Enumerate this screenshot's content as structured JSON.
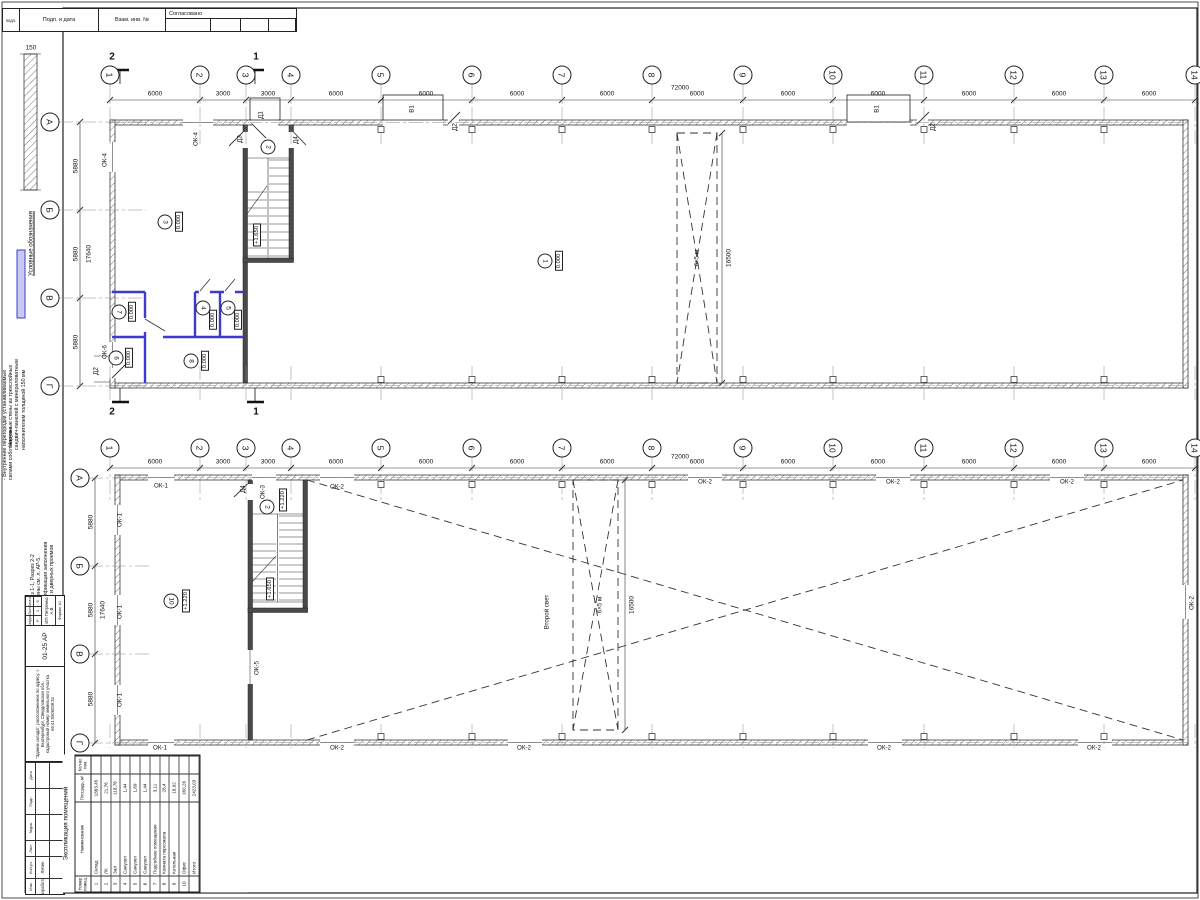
{
  "sheet": {
    "stamp_top": {
      "c1": "подл.",
      "c2": "Подп. и дата",
      "c3": "Взам. инв. №",
      "agreed": "Согласовано"
    },
    "legend": {
      "title": "Условные обозначения",
      "thickness": "150",
      "item1_lines": [
        {
          "t": "- Наружные стены из трехслойных"
        },
        {
          "t": "сандвич-панелей с минераловатным"
        },
        {
          "t": "наполнителем толщиной 150 мм"
        }
      ],
      "item2_lines": [
        {
          "t": "- Внутренние перегородки устанавливаемые"
        },
        {
          "t": "силами собственника"
        }
      ]
    },
    "notes": [
      {
        "t": "1. Разрез 1-1, Разрез 2-2"
      },
      {
        "t": "Выполнены см. л. АР-5."
      },
      {
        "t": "2. Спецификация заполнения"
      },
      {
        "t": "оконных и дверных проемов"
      }
    ],
    "labels": [
      {
        "t": "150",
        "x": 31,
        "y": 48,
        "cls": "dim"
      }
    ]
  },
  "grid": {
    "cols": [
      {
        "t": "1",
        "x": 110
      },
      {
        "t": "2",
        "x": 200
      },
      {
        "t": "3",
        "x": 246
      },
      {
        "t": "4",
        "x": 291
      },
      {
        "t": "5",
        "x": 381
      },
      {
        "t": "6",
        "x": 472
      },
      {
        "t": "7",
        "x": 562
      },
      {
        "t": "8",
        "x": 652
      },
      {
        "t": "9",
        "x": 743
      },
      {
        "t": "10",
        "x": 833
      },
      {
        "t": "11",
        "x": 924
      },
      {
        "t": "12",
        "x": 1014
      },
      {
        "t": "13",
        "x": 1104
      },
      {
        "t": "14",
        "x": 1195
      }
    ],
    "dims": [
      {
        "t": "6000",
        "x": 155
      },
      {
        "t": "3000",
        "x": 223
      },
      {
        "t": "3000",
        "x": 268
      },
      {
        "t": "6000",
        "x": 336
      },
      {
        "t": "6000",
        "x": 426
      },
      {
        "t": "6000",
        "x": 517
      },
      {
        "t": "6000",
        "x": 607
      },
      {
        "t": "6000",
        "x": 697
      },
      {
        "t": "6000",
        "x": 788
      },
      {
        "t": "6000",
        "x": 878
      },
      {
        "t": "6000",
        "x": 969
      },
      {
        "t": "6000",
        "x": 1059
      },
      {
        "t": "6000",
        "x": 1149
      }
    ]
  },
  "plan1": {
    "rows": [
      {
        "t": "А",
        "y": 122
      },
      {
        "t": "Б",
        "y": 210
      },
      {
        "t": "В",
        "y": 298
      },
      {
        "t": "Г",
        "y": 386
      }
    ],
    "dims_left": [
      {
        "t": "5880",
        "x": 76,
        "y": 166,
        "cls": "vdim"
      },
      {
        "t": "5880",
        "x": 76,
        "y": 254,
        "cls": "vdim"
      },
      {
        "t": "5880",
        "x": 76,
        "y": 342,
        "cls": "vdim"
      },
      {
        "t": "17640",
        "x": 89,
        "y": 254,
        "cls": "vdim"
      }
    ],
    "labels": [
      {
        "t": "72000",
        "x": 680,
        "y": 88,
        "cls": "dim"
      },
      {
        "t": "2",
        "x": 112,
        "y": 57,
        "cls": "sec"
      },
      {
        "t": "1",
        "x": 256,
        "y": 57,
        "cls": "sec"
      },
      {
        "t": "2",
        "x": 112,
        "y": 412,
        "cls": "sec"
      },
      {
        "t": "1",
        "x": 256,
        "y": 412,
        "cls": "sec"
      },
      {
        "t": "ОК-4",
        "x": 105,
        "y": 160,
        "cls": "wlab"
      },
      {
        "t": "ОК-4",
        "x": 196,
        "y": 139,
        "cls": "wlab"
      },
      {
        "t": "ОК-6",
        "x": 105,
        "y": 352,
        "cls": "wlab"
      },
      {
        "t": "Д2",
        "x": 96,
        "y": 371,
        "cls": "wlab"
      },
      {
        "t": "Д1",
        "x": 261,
        "y": 115,
        "cls": "wlab"
      },
      {
        "t": "Д3",
        "x": 240,
        "y": 139,
        "cls": "wlab"
      },
      {
        "t": "Д4",
        "x": 296,
        "y": 140,
        "cls": "wlab"
      },
      {
        "t": "3",
        "x": 165,
        "y": 222,
        "cls": "circ"
      },
      {
        "t": "0.000",
        "x": 179,
        "y": 222,
        "cls": "lvl"
      },
      {
        "t": "2",
        "x": 268,
        "y": 147,
        "cls": "circ"
      },
      {
        "t": "+1.650",
        "x": 257,
        "y": 235,
        "cls": "lvl"
      },
      {
        "t": "1",
        "x": 545,
        "y": 261,
        "cls": "circ"
      },
      {
        "t": "0.000",
        "x": 559,
        "y": 261,
        "cls": "lvl"
      },
      {
        "t": "7",
        "x": 119,
        "y": 312,
        "cls": "circ"
      },
      {
        "t": "0.000",
        "x": 132,
        "y": 312,
        "cls": "lvl"
      },
      {
        "t": "6",
        "x": 116,
        "y": 358,
        "cls": "circ"
      },
      {
        "t": "0.000",
        "x": 129,
        "y": 358,
        "cls": "lvl"
      },
      {
        "t": "8",
        "x": 191,
        "y": 361,
        "cls": "circ"
      },
      {
        "t": "0.000",
        "x": 205,
        "y": 361,
        "cls": "lvl"
      },
      {
        "t": "4",
        "x": 203,
        "y": 308,
        "cls": "circ"
      },
      {
        "t": "0.000",
        "x": 213,
        "y": 320,
        "cls": "lvl"
      },
      {
        "t": "5",
        "x": 228,
        "y": 308,
        "cls": "circ"
      },
      {
        "t": "0.000",
        "x": 238,
        "y": 320,
        "cls": "lvl"
      },
      {
        "t": "В1",
        "x": 412,
        "y": 109,
        "cls": "wlab"
      },
      {
        "t": "Д2",
        "x": 455,
        "y": 127,
        "cls": "wlab"
      },
      {
        "t": "В1",
        "x": 877,
        "y": 109,
        "cls": "wlab"
      },
      {
        "t": "Д2",
        "x": 933,
        "y": 127,
        "cls": "wlab"
      },
      {
        "t": "6×5 м",
        "x": 697,
        "y": 258,
        "cls": "wlab"
      },
      {
        "t": "16500",
        "x": 729,
        "y": 258,
        "cls": "vdim"
      }
    ]
  },
  "plan2": {
    "rows": [
      {
        "t": "А",
        "y": 478
      },
      {
        "t": "Б",
        "y": 566
      },
      {
        "t": "В",
        "y": 654
      },
      {
        "t": "Г",
        "y": 743
      }
    ],
    "dims_left": [
      {
        "t": "5880",
        "x": 91,
        "y": 522,
        "cls": "vdim"
      },
      {
        "t": "5880",
        "x": 91,
        "y": 610,
        "cls": "vdim"
      },
      {
        "t": "5880",
        "x": 91,
        "y": 699,
        "cls": "vdim"
      },
      {
        "t": "17640",
        "x": 103,
        "y": 610,
        "cls": "vdim"
      }
    ],
    "labels": [
      {
        "t": "72000",
        "x": 680,
        "y": 457,
        "cls": "dim"
      },
      {
        "t": "ОК-1",
        "x": 161,
        "y": 486,
        "cls": "hlab"
      },
      {
        "t": "Д4",
        "x": 243,
        "y": 489,
        "cls": "wlab"
      },
      {
        "t": "ОК-3",
        "x": 263,
        "y": 492,
        "cls": "wlab"
      },
      {
        "t": "+1.220",
        "x": 283,
        "y": 500,
        "cls": "lvl"
      },
      {
        "t": "2",
        "x": 267,
        "y": 507,
        "cls": "circ"
      },
      {
        "t": "ОК-2",
        "x": 337,
        "y": 487,
        "cls": "hlab"
      },
      {
        "t": "ОК-2",
        "x": 705,
        "y": 482,
        "cls": "hlab"
      },
      {
        "t": "ОК-2",
        "x": 893,
        "y": 482,
        "cls": "hlab"
      },
      {
        "t": "ОК-2",
        "x": 1067,
        "y": 482,
        "cls": "hlab"
      },
      {
        "t": "ОК-1",
        "x": 120,
        "y": 520,
        "cls": "wlab"
      },
      {
        "t": "ОК-1",
        "x": 120,
        "y": 612,
        "cls": "wlab"
      },
      {
        "t": "ОК-1",
        "x": 120,
        "y": 700,
        "cls": "wlab"
      },
      {
        "t": "10",
        "x": 171,
        "y": 601,
        "cls": "circ"
      },
      {
        "t": "+1.220",
        "x": 186,
        "y": 601,
        "cls": "lvl"
      },
      {
        "t": "+1.650",
        "x": 270,
        "y": 589,
        "cls": "lvl"
      },
      {
        "t": "ОК-5",
        "x": 257,
        "y": 668,
        "cls": "wlab"
      },
      {
        "t": "Второй свет",
        "x": 547,
        "y": 612,
        "cls": "wlab"
      },
      {
        "t": "6×5 м",
        "x": 600,
        "y": 605,
        "cls": "wlab"
      },
      {
        "t": "16500",
        "x": 632,
        "y": 605,
        "cls": "vdim"
      },
      {
        "t": "ОК-2",
        "x": 1192,
        "y": 603,
        "cls": "wlab"
      },
      {
        "t": "ОК-1",
        "x": 160,
        "y": 748,
        "cls": "hlab"
      },
      {
        "t": "ОК-2",
        "x": 337,
        "y": 748,
        "cls": "hlab"
      },
      {
        "t": "ОК-2",
        "x": 524,
        "y": 748,
        "cls": "hlab"
      },
      {
        "t": "ОК-2",
        "x": 884,
        "y": 748,
        "cls": "hlab"
      },
      {
        "t": "ОК-2",
        "x": 1094,
        "y": 748,
        "cls": "hlab"
      }
    ]
  },
  "title_block": {
    "hdr": [
      {
        "t": "Изм."
      },
      {
        "t": "Кол.уч."
      },
      {
        "t": "Лист"
      },
      {
        "t": "№док."
      },
      {
        "t": "Подп."
      },
      {
        "t": "Дата"
      }
    ],
    "developer_label": "Разработал",
    "developer": "Ляпин",
    "project": "\"Здание склада\", расположенное по адресу: г. Екатеринбург, Свердловская обл., кадастровый номер земельного участка 66:41:0506039:34",
    "code": "01-25 АР",
    "stage_label": "Стадия",
    "sheet_label": "Лист",
    "sheets_label": "Листов",
    "stage": "Р",
    "sheet": "1",
    "sheets": "6",
    "company": "ИП Петренко А.В.",
    "format": "Формат А1"
  },
  "room_table": {
    "title": "Экспликация помещений",
    "h1": "Номер помещ.",
    "h2": "Наименование",
    "h3": "Площадь, м²",
    "h4": "Кол-во пом.",
    "rows": [
      {
        "n": "1",
        "name": "Склад",
        "area": "1883,45",
        "q": ""
      },
      {
        "n": "2",
        "name": "ЛК",
        "area": "21,76",
        "q": ""
      },
      {
        "n": "3",
        "name": "Зал",
        "area": "118,76",
        "q": ""
      },
      {
        "n": "4",
        "name": "Санузел",
        "area": "1,44",
        "q": ""
      },
      {
        "n": "5",
        "name": "Санузел",
        "area": "1,69",
        "q": ""
      },
      {
        "n": "6",
        "name": "Санузел",
        "area": "1,44",
        "q": ""
      },
      {
        "n": "7",
        "name": "Подсобное помещение",
        "area": "3,11",
        "q": ""
      },
      {
        "n": "8",
        "name": "Комната персонала",
        "area": "28,4",
        "q": ""
      },
      {
        "n": "9",
        "name": "Котельная",
        "area": "18,92",
        "q": ""
      },
      {
        "n": "10",
        "name": "Офис",
        "area": "160,26",
        "q": ""
      }
    ],
    "total_label": "Итого",
    "total": "2423,03"
  }
}
